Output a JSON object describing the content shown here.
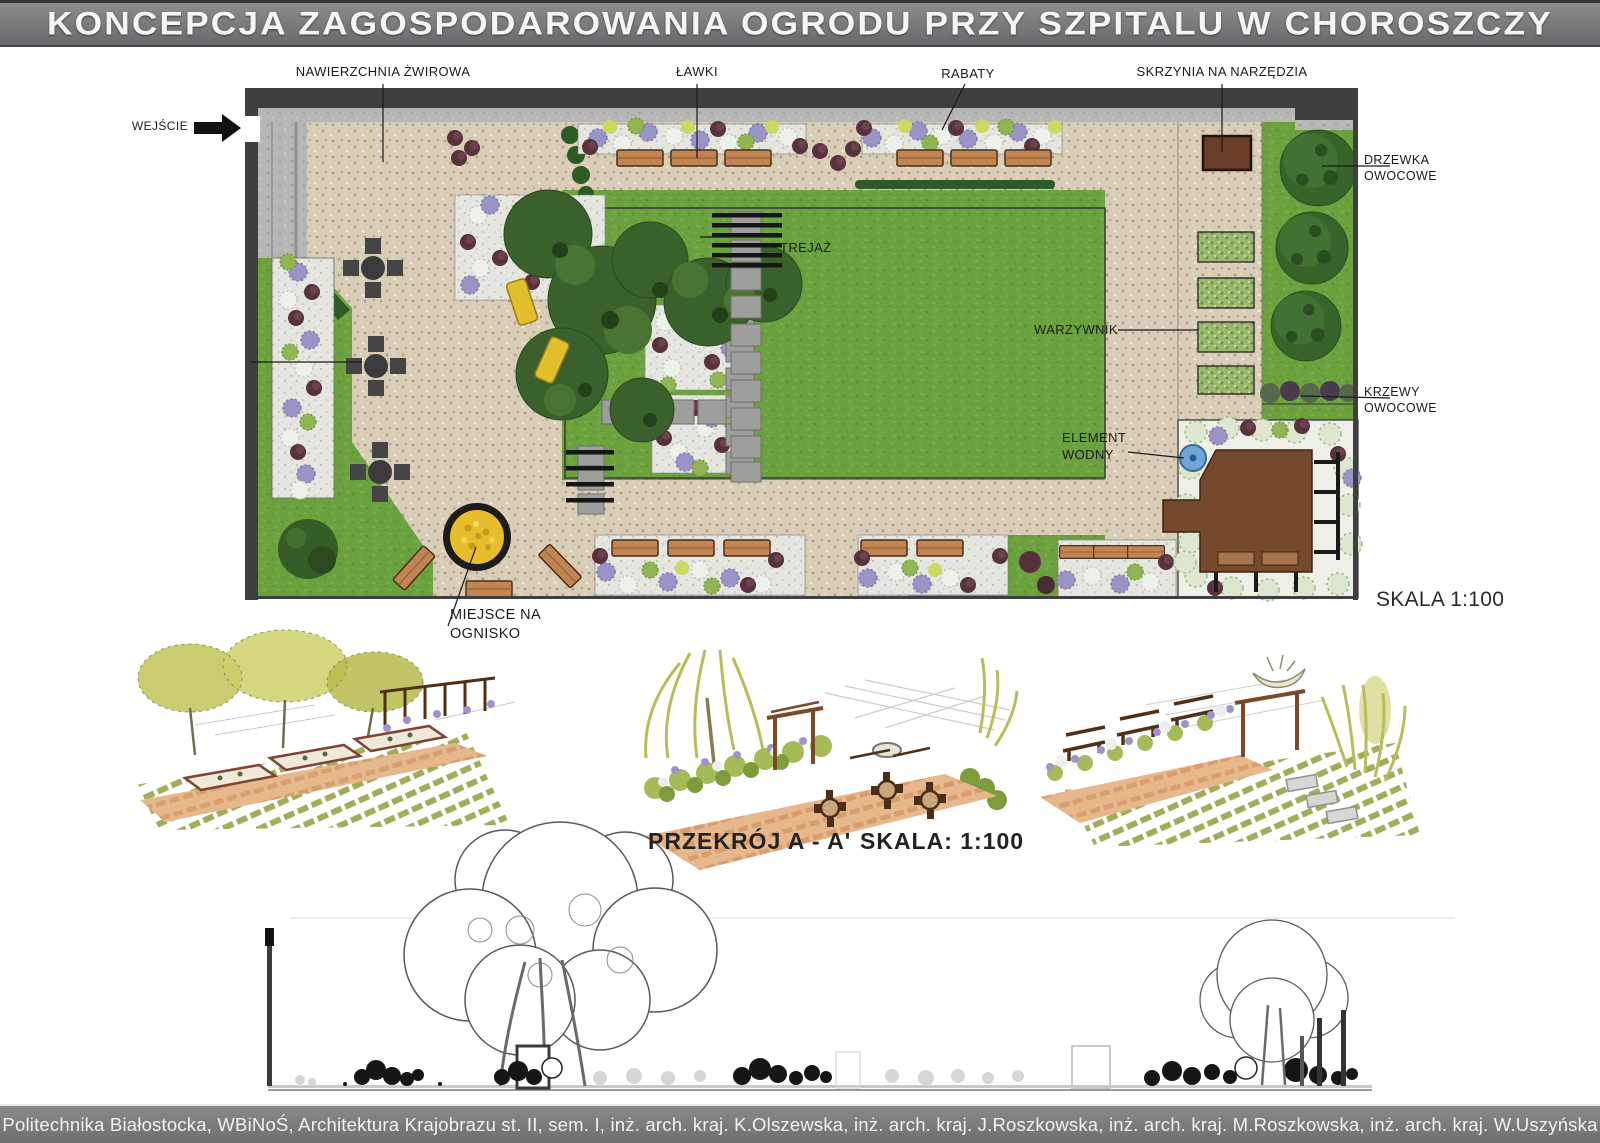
{
  "title": "KONCEPCJA ZAGOSPODAROWANIA OGRODU PRZY SZPITALU W CHOROSZCZY",
  "plan": {
    "scale_label": "SKALA 1:100",
    "labels": {
      "entrance": "WEJŚCIE",
      "gravel_surface": "NAWIERZCHNIA ŻWIROWA",
      "benches": "ŁAWKI",
      "flower_beds": "RABATY",
      "tool_chest": "SKRZYNIA NA NARZĘDZIA",
      "trellis": "TREJAŻ",
      "vegetable_garden": "WARZYWNIK",
      "fruit_trees": "DRZEWKA OWOCOWE",
      "fruit_shrubs": "KRZEWY OWOCOWE",
      "water_feature": "ELEMENT WODNY",
      "fire_pit": "MIEJSCE NA OGNISKO"
    }
  },
  "section": {
    "label": "PRZEKRÓJ  A - A'",
    "scale_label": "SKALA: 1:100"
  },
  "footer": "Politechnika Białostocka, WBiNoŚ, Architektura Krajobrazu st. II, sem. I, inż. arch. kraj. K.Olszewska, inż. arch. kraj. J.Roszkowska, inż. arch. kraj. M.Roszkowska, inż. arch. kraj. W.Uszyńska",
  "colors": {
    "lawn": "#6ba23e",
    "gravel": "#d9cdb7",
    "wall": "#3f3f41",
    "deck": "#74492c",
    "water": "#6fa8d8",
    "bench": "#c08552",
    "fire_pit": "#e7bd2e",
    "accent_purple": "#9a93c6",
    "accent_maroon": "#55303b"
  }
}
